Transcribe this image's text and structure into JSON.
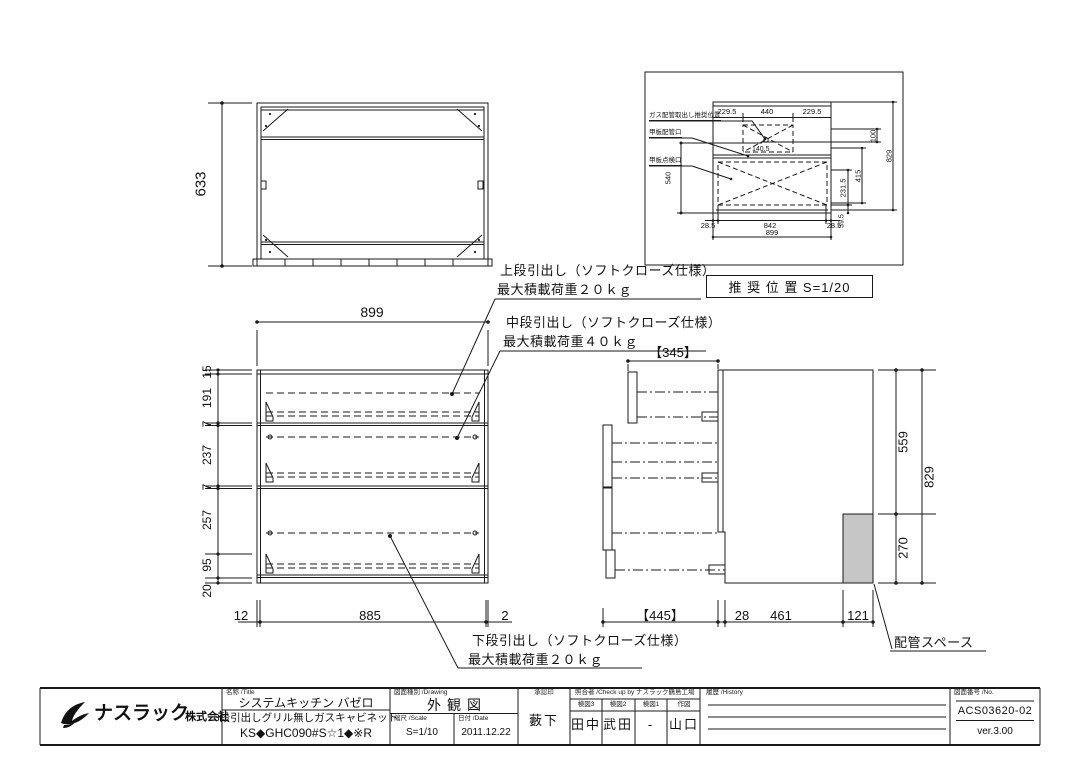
{
  "colors": {
    "line": "#1a1a1a",
    "gray_fill": "#c6c6c6",
    "bg": "#ffffff"
  },
  "plan_view": {
    "depth": "633"
  },
  "detail_view": {
    "scale_note": "推 奨 位 置  S=1/20",
    "label_gas": "ガス配管取出し推奨位置",
    "label_pipe": "甲板配管口",
    "label_inspect": "甲板点検口",
    "dim_top": [
      "229.5",
      "440",
      "229.5"
    ],
    "dim_540": "540",
    "dim_140": "140.5",
    "dim_231": "231.5",
    "dim_415": "415",
    "dim_100": "100",
    "dim_829": "829",
    "dim_39": "39.5",
    "dim_bot": [
      "28.5",
      "842",
      "28.5"
    ],
    "dim_total": "899"
  },
  "annotations": {
    "upper_line1": "上段引出し（ソフトクローズ仕様）",
    "upper_line2": "最大積載荷重２０ｋｇ",
    "middle_line1": "中段引出し（ソフトクローズ仕様）",
    "middle_line2": "最大積載荷重４０ｋｇ",
    "lower_line1": "下段引出し（ソフトクローズ仕様）",
    "lower_line2": "最大積載荷重２０ｋｇ",
    "piping_space": "配管スペース"
  },
  "front_view": {
    "dim_width": "899",
    "dims_left": [
      "15",
      "191",
      "7",
      "237",
      "7",
      "257",
      "95",
      "20"
    ],
    "dim_bottom_left": "12",
    "dim_bottom_center": "885",
    "dim_bottom_right": "2"
  },
  "side_view": {
    "dim_top": "【345】",
    "dim_bottom_1": "【445】",
    "dim_bottom_2": "28",
    "dim_bottom_3": "461",
    "dim_bottom_4": "121",
    "dim_right_upper": "559",
    "dim_right_total": "829",
    "dim_right_lower": "270"
  },
  "title_block": {
    "company": "ナスラック",
    "company_suffix": "株式会社",
    "name_header": "名称 /Title",
    "product_series": "システムキッチン バゼロ",
    "product_desc": "3段引出しグリル無しガスキャビネット",
    "product_code": "KS◆GHC090#S☆1◆※R",
    "drawing_header": "図面種別 /Drawing",
    "drawing_type": "外観図",
    "scale_header": "縮尺 /Scale",
    "scale_value": "S=1/10",
    "date_header": "日付 /Date",
    "date_value": "2011.12.22",
    "approval_header": "承認印",
    "approval_name": "藪下",
    "check_header": "照合者 /Check up by ナスラック鶴島工場",
    "check_cols": [
      {
        "label": "検図3",
        "value": "田中"
      },
      {
        "label": "検図2",
        "value": "武田"
      },
      {
        "label": "検図1",
        "value": "-"
      },
      {
        "label": "作図",
        "value": "山口"
      }
    ],
    "history_header": "履歴 /History",
    "number_header": "図面番号 /No.",
    "drawing_number": "ACS03620-02",
    "version": "ver.3.00"
  }
}
